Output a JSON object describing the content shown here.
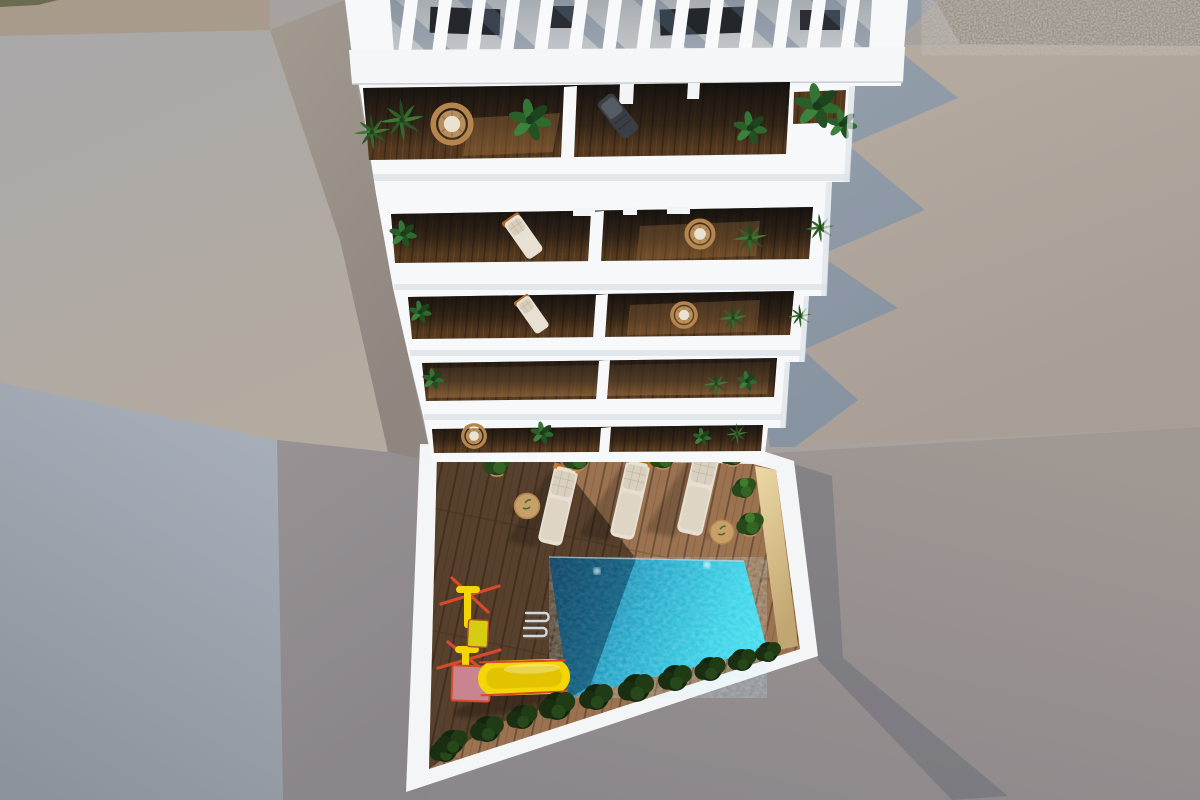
{
  "scene": {
    "title": "Aerial 3D architectural render: white apartment tower with plant-filled balconies and rooftop pergola above a pool terrace with sun loungers and a yellow playground slide",
    "floors_visible": 5,
    "balcony_units_per_floor": 2,
    "sun_loungers": 3,
    "side_tables": 2,
    "pool_lamps": 2
  },
  "colors": {
    "building_white": "#f6f8fa",
    "pergola_recess": "#b4b9be",
    "balcony_wood": "#55391f",
    "deck_wood": "#9b7351",
    "deck_stripe": "#6e4f37",
    "pool_deep": "#0b5a84",
    "pool_mid": "#17a0c4",
    "pool_bright": "#2fd0e6",
    "pool_lamp": "#eafcff",
    "sand_wall_light": "#ecd9a6",
    "sand_wall_dark": "#c2a671",
    "shrub_green": "#1d3314",
    "leaf_green": "#2e6b2e",
    "palm_green": "#3c7a35",
    "wicker_tan": "#b5854e",
    "cushion_cream": "#e9e1d2",
    "lounger_cream": "#e7dfd1",
    "lounger_head": "#d9cfbe",
    "lounger_trim": "#b06a2e",
    "slide_yellow": "#f4d607",
    "frame_red": "#d9492c",
    "platform_pink": "#c9848f",
    "box_yellow": "#d6cc12",
    "table_tan": "#c99f68",
    "ladder_chrome": "#d3d8dd",
    "pavement_lit_1": "#b6aba0",
    "pavement_lit_2": "#a89e96",
    "shadow_blue_1": "#97a1ae",
    "shadow_blue_2": "#8792a0",
    "street_1": "#a09893",
    "street_2": "#8c878b",
    "roof_left_1": "#a9a8a9",
    "roof_left_2": "#b3aaa0",
    "inset_1": "#a6aeb9",
    "inset_2": "#8d939c",
    "left_wall_1": "#989294",
    "left_wall_2": "#8a8589",
    "wedge_1": "#a39a90",
    "wedge_2": "#8e867f",
    "strip_top": "#a89b8c",
    "gravel_base": "#8e8880",
    "glass_dark": "#0a0b0d"
  }
}
